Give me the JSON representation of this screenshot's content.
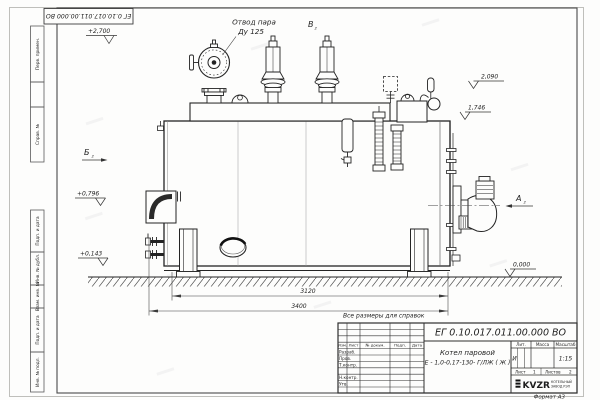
{
  "page": {
    "stamp_doc_number": "ЕГ 0.10.017.011.00.000  ВО",
    "note_reference": "Все размеры для справок",
    "format_label": "Формат А3"
  },
  "title_block": {
    "doc_number": "ЕГ 0.10.017.011.00.000  ВО",
    "product_title_line1": "Котел паровой",
    "product_title_line2": "Е - 1,0-0,17-130- Г/ЛЖ ( Ж )",
    "headers": {
      "lit": "Лит.",
      "mass": "Масса",
      "scale": "Масштаб"
    },
    "lit_value": "И",
    "scale_value": "1:15",
    "sheet_label": "Лист",
    "sheet_value": "1",
    "sheets_label": "Листов",
    "sheets_value": "2",
    "rev_headers": {
      "izm": "Изм.",
      "list": "Лист",
      "doc": "№ докум.",
      "sign": "Подп.",
      "date": "Дата"
    },
    "sig_rows": {
      "developed": "Разраб.",
      "checked": "Пров.",
      "tcontrol": "Т.контр.",
      "ncontrol": "Н.контр.",
      "approved": "Утв."
    },
    "logo_text": "KVZR",
    "logo_org_line1": "КОТЕЛЬНЫЙ",
    "logo_org_line2": "ЗАВОД РЭП"
  },
  "margin_labels": {
    "perv": "Перв. примен.",
    "sprav": "Справ. №",
    "podp1": "Подп. и дата",
    "inv_dubl": "Инв. № дубл.",
    "vzam": "Взам. инв. №",
    "podp2": "Подп. и дата",
    "inv_podl": "Инв. № подл."
  },
  "annotations": {
    "steam_outlet_line1": "Отвод пара",
    "steam_outlet_line2": "Ду 125",
    "view_a": "А",
    "view_b": "Б",
    "view_v": "В",
    "view_sub": "2",
    "elev_top": "+2,700",
    "elev_2090": "2,090",
    "elev_1746": "1,746",
    "elev_0796": "+0,796",
    "elev_0143": "+0,143",
    "elev_zero": "0,000",
    "dim_inner": "3120",
    "dim_outer": "3400"
  }
}
